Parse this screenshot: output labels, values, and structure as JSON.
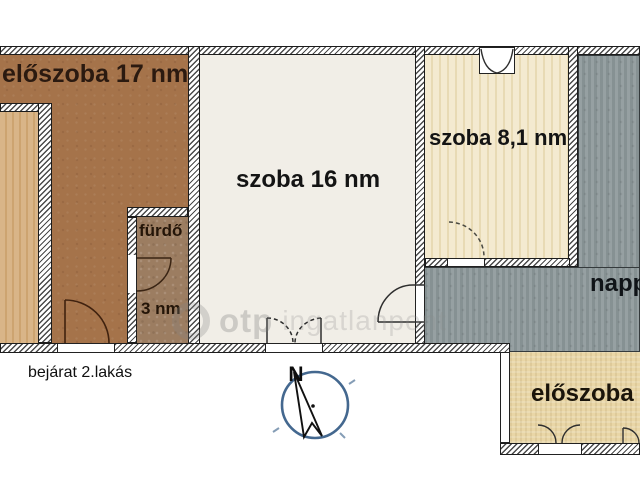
{
  "floorplan": {
    "rooms": {
      "hall17": {
        "label": "előszoba 17 nm"
      },
      "room16": {
        "label": "szoba 16 nm"
      },
      "room81": {
        "label": "szoba 8,1 nm"
      },
      "bath": {
        "label": "fürdő",
        "area": "3 nm"
      },
      "living": {
        "label": "napp"
      },
      "hall2": {
        "label": "előszoba"
      }
    },
    "annotations": {
      "entrance": "bejárat 2.lakás"
    },
    "compass": {
      "north": "N"
    },
    "watermark": {
      "brand": "otp",
      "name": "ingatlanpont"
    },
    "colors": {
      "hall17_floor": "#a5734a",
      "left_room_floor": "#d9b588",
      "bath_floor": "#9c7d61",
      "room16_floor": "#f1eee7",
      "room81_floor": "#f2e8cd",
      "living_floor": "#8d989a",
      "hall2_floor": "#e9d6a6",
      "wall_hatch": "#4a4a4a",
      "compass_ring": "#44688f"
    }
  }
}
